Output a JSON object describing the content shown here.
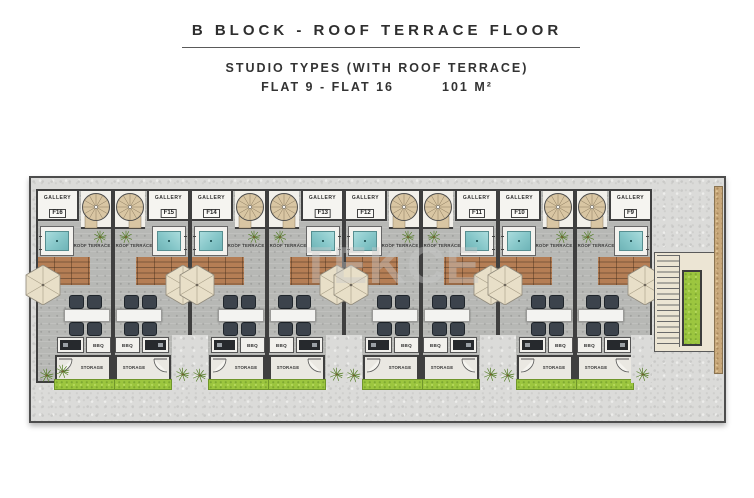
{
  "header": {
    "title": "B BLOCK - ROOF TERRACE FLOOR",
    "subtitle": "STUDIO TYPES (WITH ROOF TERRACE)",
    "flats_range": "FLAT 9 - FLAT 16",
    "area": "101 M²"
  },
  "watermark": "TEKCE",
  "labels": {
    "gallery": "GALLERY",
    "roof_terrace": "ROOF TERRACE",
    "bbq": "BBQ",
    "storage": "STORAGE"
  },
  "plan": {
    "units": [
      {
        "flat_code": "F16",
        "mirrored": false
      },
      {
        "flat_code": "F15",
        "mirrored": true
      },
      {
        "flat_code": "F14",
        "mirrored": false
      },
      {
        "flat_code": "F13",
        "mirrored": true
      },
      {
        "flat_code": "F12",
        "mirrored": false
      },
      {
        "flat_code": "F11",
        "mirrored": true
      },
      {
        "flat_code": "F10",
        "mirrored": false
      },
      {
        "flat_code": "F9",
        "mirrored": true
      }
    ]
  },
  "colors": {
    "wall": "#3f3f3f",
    "concrete": "#dbdbd9",
    "terrace_floor": "#b7b8b5",
    "deck_wood": "#b07a50",
    "jacuzzi_water": "#85c6c8",
    "lawn": "#9cc63f",
    "stair_wood": "#d9c6a3",
    "umbrella": "#e8dfc8",
    "chair": "#3c434c",
    "grill": "#26292d",
    "wood_wall": "#c8a87b"
  }
}
